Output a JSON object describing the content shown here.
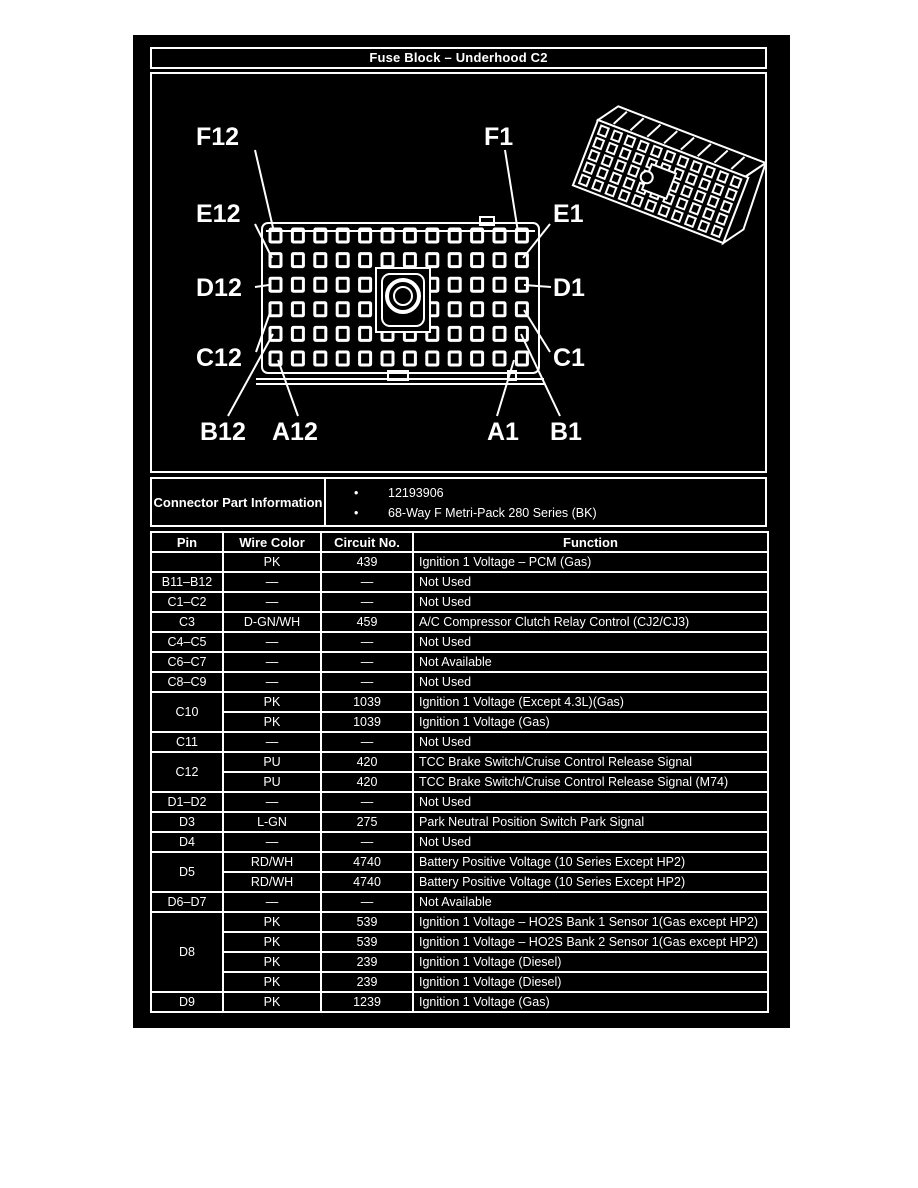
{
  "title": "Fuse Block – Underhood C2",
  "colors": {
    "page_bg": "#ffffff",
    "panel_bg": "#000000",
    "line_fg": "#ffffff"
  },
  "diagram": {
    "pin_labels": [
      "F12",
      "F1",
      "E12",
      "E1",
      "D12",
      "D1",
      "C12",
      "C1",
      "B12",
      "A12",
      "A1",
      "B1"
    ],
    "views": [
      "connector-face-front-view",
      "connector-isometric-view"
    ]
  },
  "connector_info": {
    "label": "Connector Part Information",
    "bullet_icon": "•",
    "items": [
      "12193906",
      "68-Way F Metri-Pack 280 Series (BK)"
    ]
  },
  "pin_table": {
    "headers": [
      "Pin",
      "Wire Color",
      "Circuit No.",
      "Function"
    ],
    "groups": [
      {
        "pin": "",
        "rows": [
          {
            "wire": "PK",
            "circuit": "439",
            "function": "Ignition 1 Voltage – PCM (Gas)"
          }
        ]
      },
      {
        "pin": "B11–B12",
        "rows": [
          {
            "wire": "—",
            "circuit": "—",
            "function": "Not Used"
          }
        ]
      },
      {
        "pin": "C1–C2",
        "rows": [
          {
            "wire": "—",
            "circuit": "—",
            "function": "Not Used"
          }
        ]
      },
      {
        "pin": "C3",
        "rows": [
          {
            "wire": "D-GN/WH",
            "circuit": "459",
            "function": "A/C Compressor Clutch Relay Control (CJ2/CJ3)"
          }
        ]
      },
      {
        "pin": "C4–C5",
        "rows": [
          {
            "wire": "—",
            "circuit": "—",
            "function": "Not Used"
          }
        ]
      },
      {
        "pin": "C6–C7",
        "rows": [
          {
            "wire": "—",
            "circuit": "—",
            "function": "Not Available"
          }
        ]
      },
      {
        "pin": "C8–C9",
        "rows": [
          {
            "wire": "—",
            "circuit": "—",
            "function": "Not Used"
          }
        ]
      },
      {
        "pin": "C10",
        "rows": [
          {
            "wire": "PK",
            "circuit": "1039",
            "function": "Ignition 1 Voltage (Except 4.3L)(Gas)"
          },
          {
            "wire": "PK",
            "circuit": "1039",
            "function": "Ignition 1 Voltage (Gas)"
          }
        ]
      },
      {
        "pin": "C11",
        "rows": [
          {
            "wire": "—",
            "circuit": "—",
            "function": "Not Used"
          }
        ]
      },
      {
        "pin": "C12",
        "rows": [
          {
            "wire": "PU",
            "circuit": "420",
            "function": "TCC Brake Switch/Cruise Control Release Signal"
          },
          {
            "wire": "PU",
            "circuit": "420",
            "function": "TCC Brake Switch/Cruise Control Release Signal (M74)"
          }
        ]
      },
      {
        "pin": "D1–D2",
        "rows": [
          {
            "wire": "—",
            "circuit": "—",
            "function": "Not Used"
          }
        ]
      },
      {
        "pin": "D3",
        "rows": [
          {
            "wire": "L-GN",
            "circuit": "275",
            "function": "Park Neutral Position Switch Park Signal"
          }
        ]
      },
      {
        "pin": "D4",
        "rows": [
          {
            "wire": "—",
            "circuit": "—",
            "function": "Not Used"
          }
        ]
      },
      {
        "pin": "D5",
        "rows": [
          {
            "wire": "RD/WH",
            "circuit": "4740",
            "function": "Battery Positive Voltage (10 Series Except HP2)"
          },
          {
            "wire": "RD/WH",
            "circuit": "4740",
            "function": "Battery Positive Voltage (10 Series Except HP2)"
          }
        ]
      },
      {
        "pin": "D6–D7",
        "rows": [
          {
            "wire": "—",
            "circuit": "—",
            "function": "Not Available"
          }
        ]
      },
      {
        "pin": "D8",
        "rows": [
          {
            "wire": "PK",
            "circuit": "539",
            "function": "Ignition 1 Voltage – HO2S Bank 1 Sensor 1(Gas except HP2)"
          },
          {
            "wire": "PK",
            "circuit": "539",
            "function": "Ignition 1 Voltage – HO2S Bank 2 Sensor 1(Gas except HP2)"
          },
          {
            "wire": "PK",
            "circuit": "239",
            "function": "Ignition 1 Voltage (Diesel)"
          },
          {
            "wire": "PK",
            "circuit": "239",
            "function": "Ignition 1 Voltage (Diesel)"
          }
        ]
      },
      {
        "pin": "D9",
        "rows": [
          {
            "wire": "PK",
            "circuit": "1239",
            "function": "Ignition 1 Voltage (Gas)"
          }
        ]
      }
    ]
  }
}
